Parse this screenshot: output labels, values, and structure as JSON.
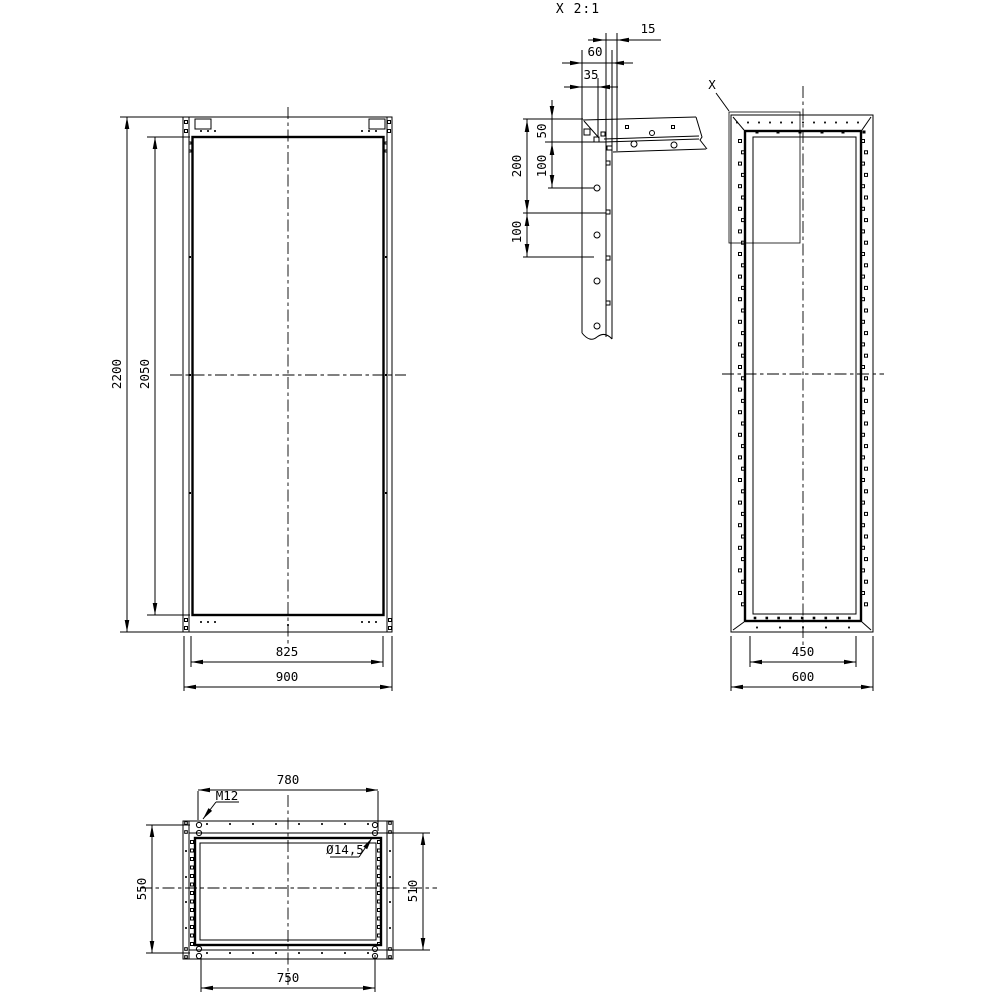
{
  "detail_view": {
    "title": "X 2:1",
    "flange_lip": "15",
    "flange_width": "60",
    "web_offset": "35",
    "first_hole_offset": "50",
    "hole_pitch_upper": "100",
    "span": "200",
    "hole_pitch_lower": "100"
  },
  "front_view": {
    "height_overall": "2200",
    "height_inner": "2050",
    "width_inner": "825",
    "width_overall": "900"
  },
  "side_view": {
    "detail_label": "X",
    "width_inner": "450",
    "width_overall": "600"
  },
  "top_view": {
    "hole_pitch_width_top": "780",
    "hole_pitch_height_left": "550",
    "hole_pitch_height_right": "510",
    "hole_pitch_width_bottom": "750",
    "thread_label": "M12",
    "hole_diameter_label": "Ø14,5"
  }
}
